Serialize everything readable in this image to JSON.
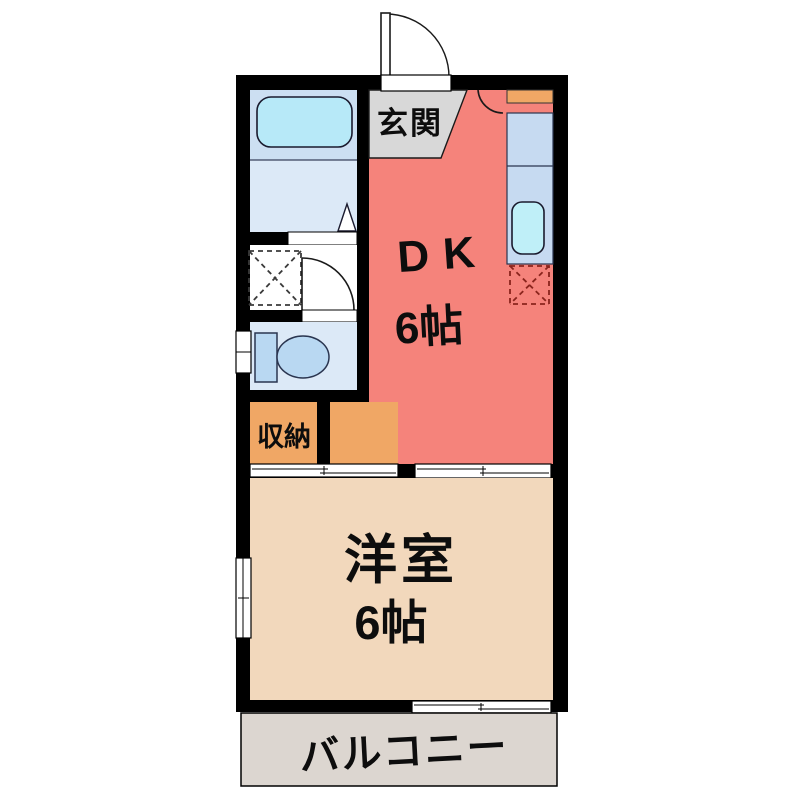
{
  "plan": {
    "type": "japanese-apartment-floorplan",
    "labels": {
      "entrance": "玄関",
      "dining_kitchen": "DK",
      "dining_kitchen_size": "6帖",
      "storage": "収納",
      "western_room": "洋室",
      "western_room_size": "6帖",
      "balcony": "バルコニー"
    },
    "fixtures": {
      "bathtub": "bathtub-icon",
      "toilet": "toilet-icon",
      "kitchen_sink": "kitchen-sink-icon",
      "washing_machine_space": "washing-machine-space-icon",
      "gas_range_space": "gas-range-space-icon",
      "shoe_cabinet": "shoe-cabinet",
      "entrance_door": "entrance-door-icon"
    },
    "colors": {
      "wall": "#000000",
      "dk_floor": "#F5837B",
      "western_room_floor": "#F2D8BC",
      "storage_floor": "#F0A765",
      "entrance_floor": "#D8D8D8",
      "balcony_floor": "#DCD6D0",
      "bath_zone": "#CCDFF2",
      "washroom_zone": "#DCE9F7",
      "bathtub": "#B7E9F8",
      "kitchen_counter": "#C6DAF1",
      "sink": "#BFEFF8",
      "toilet_fixture": "#B9D8F2",
      "range_dash": "#8A241C",
      "white": "#FFFFFF"
    }
  }
}
